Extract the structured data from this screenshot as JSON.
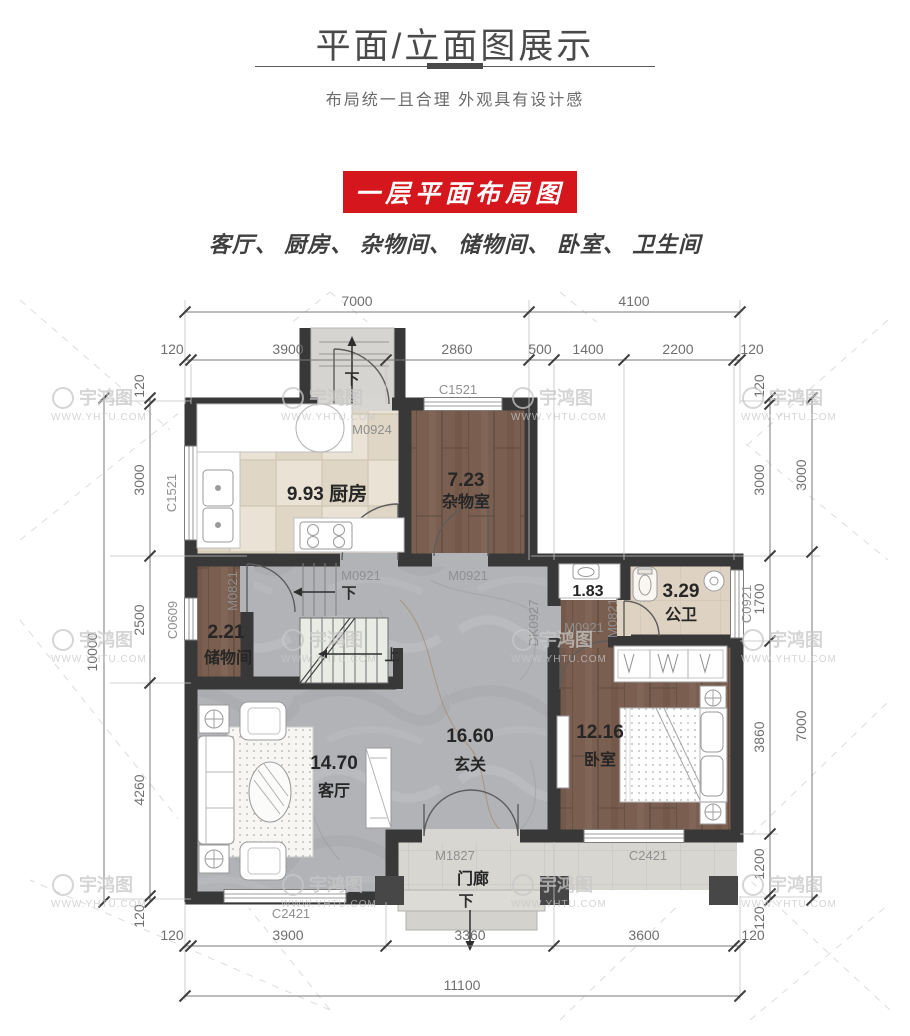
{
  "header": {
    "title": "平面/立面图展示",
    "subtitle": "布局统一且合理  外观具有设计感",
    "banner": "一层平面布局图",
    "rooms_line": "客厅、 厨房、 杂物间、 储物间、 卧室、 卫生间"
  },
  "watermark": {
    "name": "宇鸿图",
    "url": "WWW.YHTU.COM"
  },
  "colors": {
    "banner_red": "#d5161c",
    "wall": "#383838",
    "wood": "#7a5f50",
    "marble": "#b1b3b7"
  },
  "plan": {
    "rooms": {
      "kitchen": {
        "label": "9.93 厨房"
      },
      "sundry": {
        "area": "7.23",
        "name": "杂物室"
      },
      "storage": {
        "area": "2.21",
        "name": "储物间"
      },
      "hall": {
        "area": "16.60",
        "name": "玄关"
      },
      "living": {
        "area": "14.70",
        "name": "客厅"
      },
      "bedroom": {
        "area": "12.16",
        "name": "卧室"
      },
      "bath": {
        "area": "3.29",
        "name": "公卫"
      },
      "wash": {
        "area": "1.83"
      },
      "porch": {
        "name": "门廊"
      }
    },
    "stairs": {
      "up": "上",
      "down": "下"
    },
    "tags": {
      "m0924": "M0924",
      "m0921": "M0921",
      "m0821": "M0821",
      "m1827": "M1827",
      "dk0927": "DK0927",
      "c1521": "C1521",
      "c0609": "C0609",
      "c0921": "C0921",
      "c2421": "C2421"
    },
    "dims": {
      "top1": [
        "7000",
        "4100"
      ],
      "top2": [
        "120",
        "3900",
        "2860",
        "500",
        "1400",
        "2200",
        "120"
      ],
      "left_total": "10000",
      "left": [
        "120",
        "3000",
        "2500",
        "4260",
        "120"
      ],
      "right_inner": [
        "120",
        "3000",
        "1700",
        "3860",
        "1200",
        "120"
      ],
      "right_outer": [
        "3000",
        "7000"
      ],
      "bottom1": [
        "120",
        "3900",
        "3360",
        "3600",
        "120"
      ],
      "bottom_total": "11100"
    }
  }
}
